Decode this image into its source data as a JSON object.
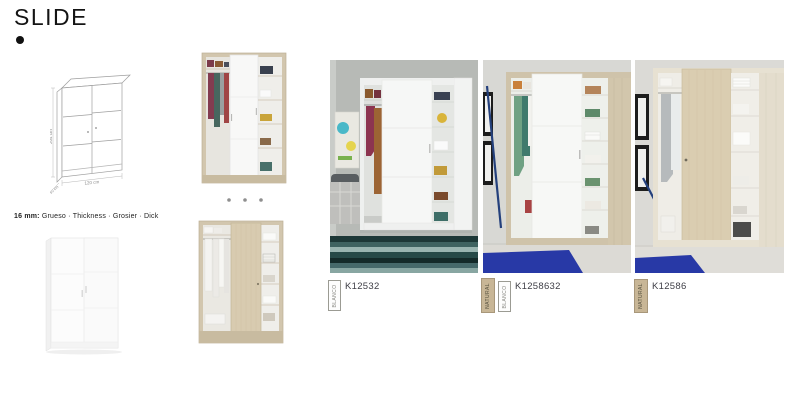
{
  "header": {
    "title": "SLIDE"
  },
  "drawing": {
    "height_label": "204 cm",
    "width_label": "120 cm",
    "depth_label": "50 cm"
  },
  "note": {
    "bold": "16 mm:",
    "rest": " Grueso · Thickness · Grosier · Dick"
  },
  "products": [
    {
      "code": "K12532",
      "swatches": [
        {
          "name": "BLANCO",
          "hex": "#fdfdfd"
        }
      ]
    },
    {
      "code": "K1258632",
      "swatches": [
        {
          "name": "NATURAL",
          "hex": "#c8b696"
        },
        {
          "name": "BLANCO",
          "hex": "#fdfdfd"
        }
      ]
    },
    {
      "code": "K12586",
      "swatches": [
        {
          "name": "NATURAL",
          "hex": "#c8b696"
        }
      ]
    }
  ],
  "colors": {
    "wood": "#d2c6ae",
    "title_text": "#141414",
    "code_text": "#3e3e46",
    "rug_teal": "#2c4a49",
    "rug_blue": "#2839a6",
    "wall_gray": "#b7bab6",
    "wall_light": "#d8d8d4"
  }
}
